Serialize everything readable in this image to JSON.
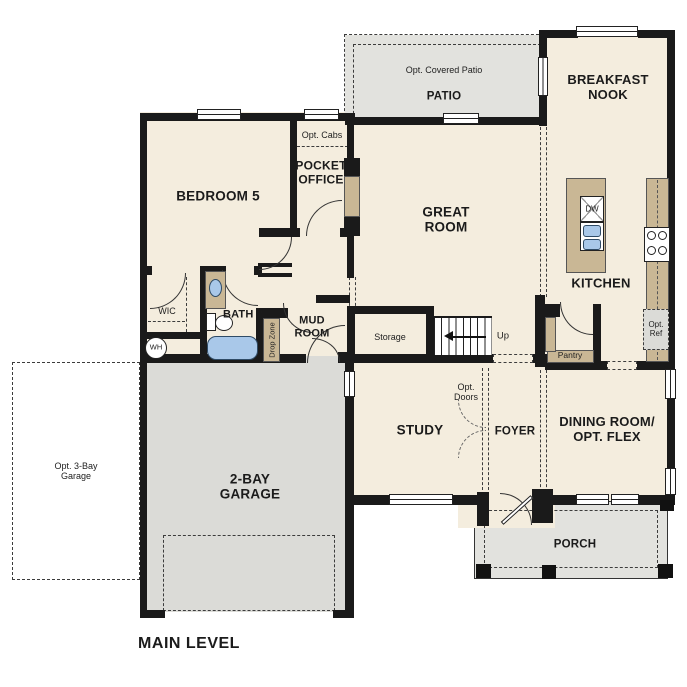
{
  "title": "MAIN LEVEL",
  "colors": {
    "floor": "#f4edde",
    "garage_fill": "#dbdbd7",
    "patio_porch_fill": "#e2e2de",
    "cabinet_tan": "#c9b795",
    "fixture_blue": "#a9c8e9",
    "wall": "#1a1a1a"
  },
  "rooms": {
    "bedroom5": "BEDROOM 5",
    "pocket_office": "POCKET OFFICE",
    "opt_cabs": "Opt. Cabs",
    "great_room": "GREAT ROOM",
    "patio": "PATIO",
    "opt_covered_patio": "Opt. Covered Patio",
    "breakfast_nook": "BREAKFAST NOOK",
    "kitchen": "KITCHEN",
    "wic": "WIC",
    "bath2": "BATH 2",
    "mud_room": "MUD ROOM",
    "drop_zone": "Drop Zone",
    "storage": "Storage",
    "stairs_up": "Up",
    "study": "STUDY",
    "opt_doors": "Opt. Doors",
    "foyer": "FOYER",
    "dining": "DINING ROOM/ OPT. FLEX",
    "pantry": "Pantry",
    "porch": "PORCH",
    "garage_2bay": "2-BAY GARAGE",
    "garage_opt_3bay": "Opt. 3-Bay Garage"
  },
  "fixtures": {
    "water_heater": "WH",
    "dishwasher": "DW",
    "opt_ref": "Opt. Ref"
  }
}
